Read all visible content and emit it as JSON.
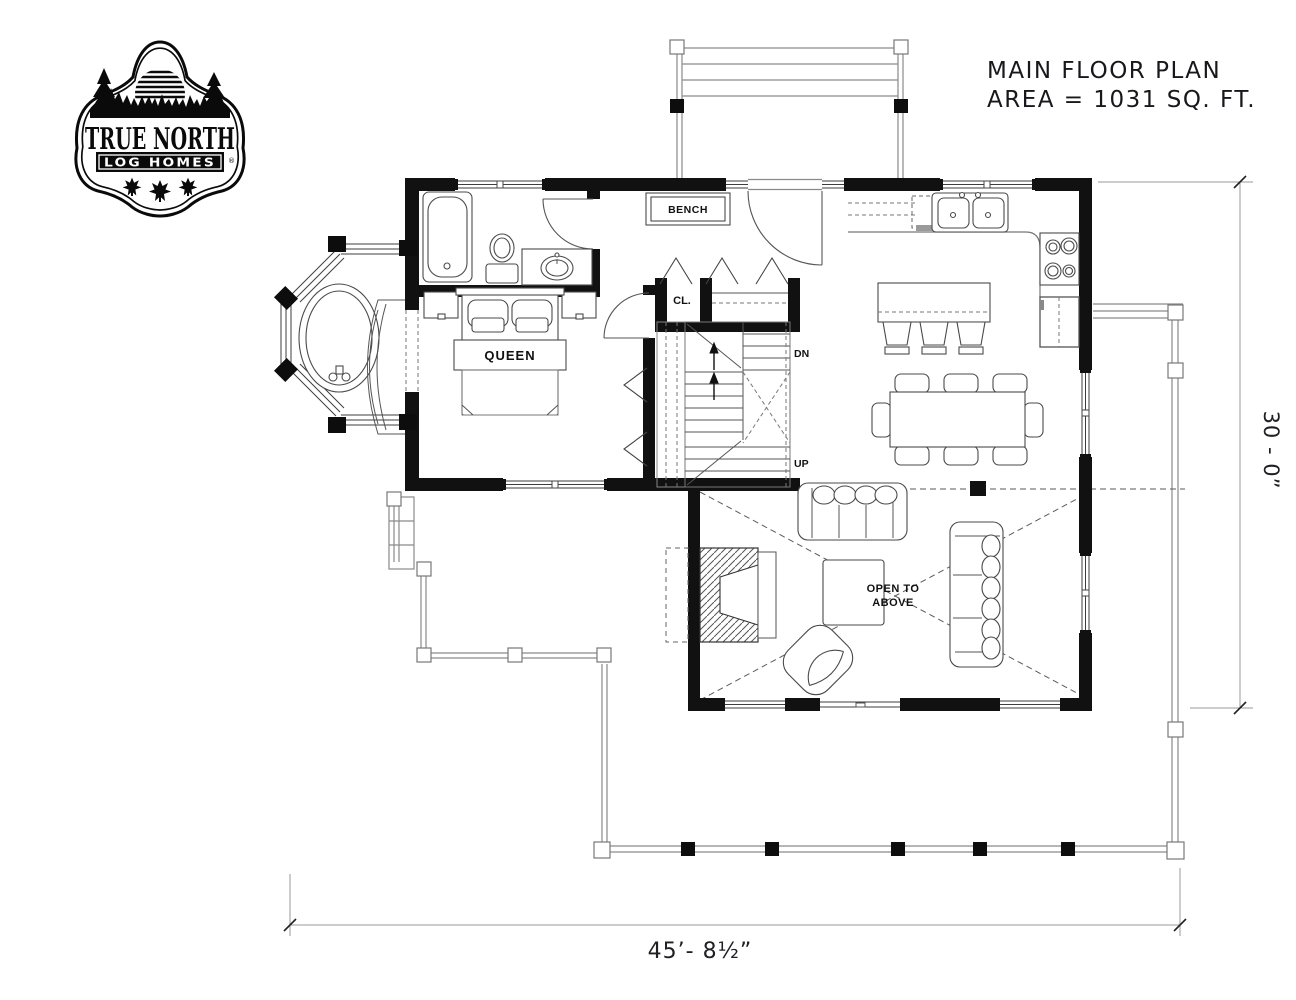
{
  "logo": {
    "title": "TRUE NORTH",
    "subtitle": "LOG HOMES",
    "registered_mark": "®"
  },
  "title_block": {
    "line1": "MAIN FLOOR PLAN",
    "line2": "AREA = 1031 SQ. FT."
  },
  "labels": {
    "bench": "BENCH",
    "closet": "CL.",
    "stairs_down": "DN",
    "stairs_up": "UP",
    "bed": "QUEEN",
    "open_above_1": "OPEN TO",
    "open_above_2": "ABOVE"
  },
  "dimensions": {
    "overall_width": "45’- 8½”",
    "overall_depth": "30 - 0”"
  },
  "colors": {
    "walls": "#111111",
    "thin_line": "#555555",
    "porch_line": "#8a8a8a",
    "background": "#ffffff"
  }
}
